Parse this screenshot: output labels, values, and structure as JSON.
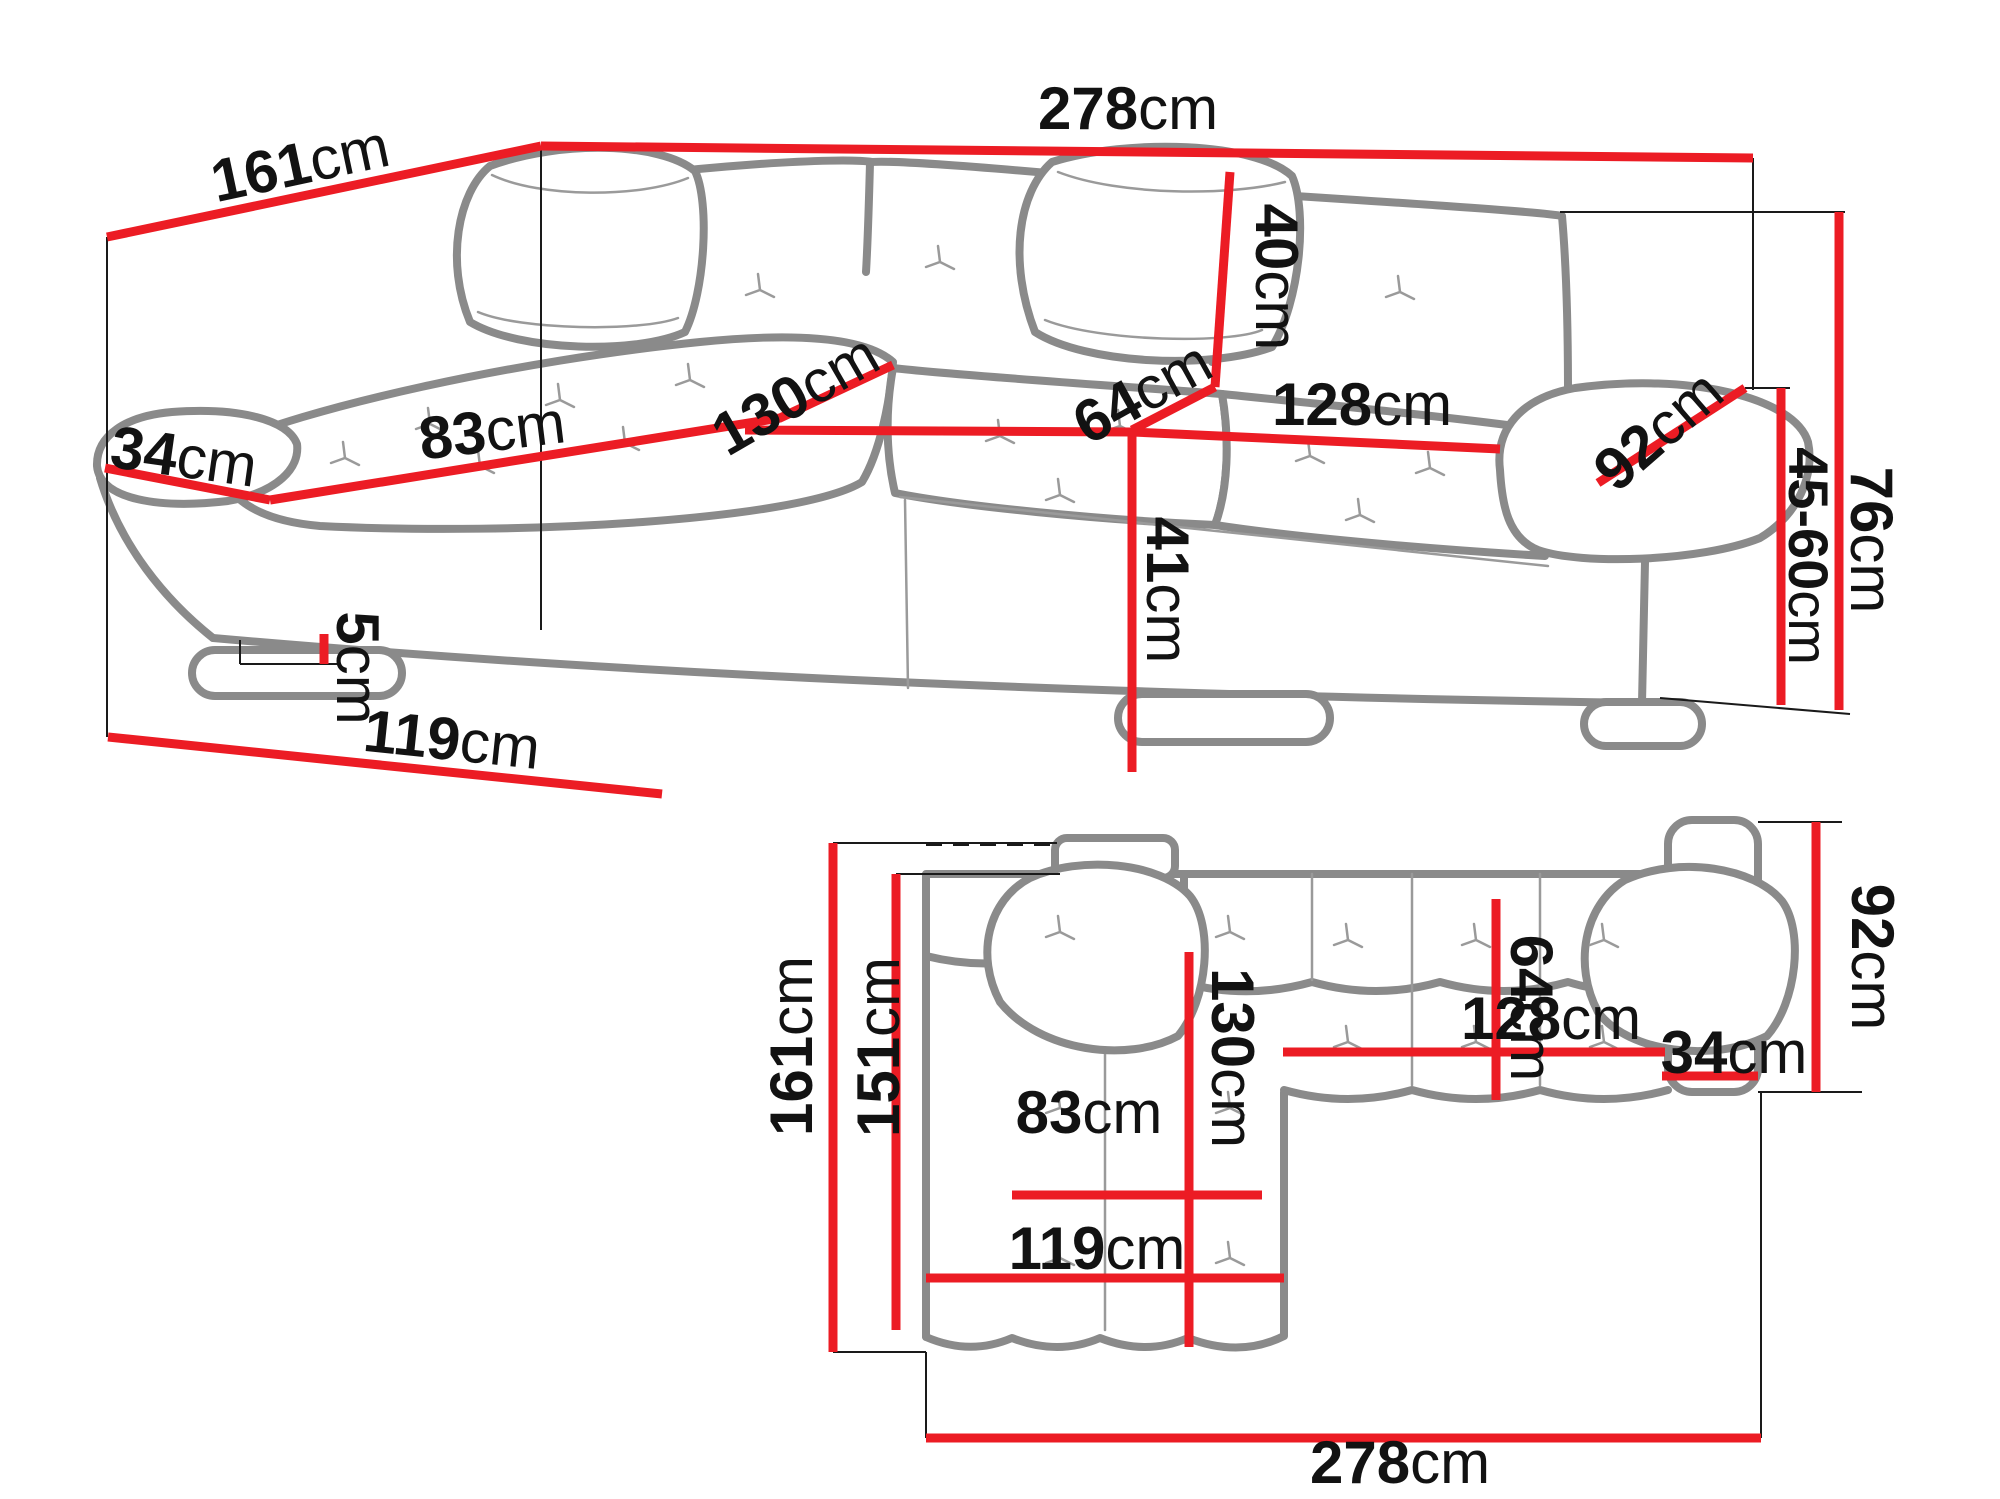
{
  "diagram": {
    "type": "furniture-dimension-drawing",
    "subject": "corner-sofa",
    "views": {
      "perspective": {
        "name": "perspective-view",
        "dimensions": [
          {
            "id": "p161",
            "value": "161",
            "unit": "cm"
          },
          {
            "id": "p278",
            "value": "278",
            "unit": "cm"
          },
          {
            "id": "p40",
            "value": "40",
            "unit": "cm"
          },
          {
            "id": "p64",
            "value": "64",
            "unit": "cm"
          },
          {
            "id": "p128",
            "value": "128",
            "unit": "cm"
          },
          {
            "id": "p92",
            "value": "92",
            "unit": "cm"
          },
          {
            "id": "p76",
            "value": "76",
            "unit": "cm"
          },
          {
            "id": "p4560",
            "value": "45-60",
            "unit": "cm"
          },
          {
            "id": "p41",
            "value": "41",
            "unit": "cm"
          },
          {
            "id": "p34",
            "value": "34",
            "unit": "cm"
          },
          {
            "id": "p83",
            "value": "83",
            "unit": "cm"
          },
          {
            "id": "p130",
            "value": "130",
            "unit": "cm"
          },
          {
            "id": "p5",
            "value": "5",
            "unit": "cm"
          },
          {
            "id": "p119",
            "value": "119",
            "unit": "cm"
          }
        ]
      },
      "plan": {
        "name": "top-plan-view",
        "dimensions": [
          {
            "id": "q161",
            "value": "161",
            "unit": "cm"
          },
          {
            "id": "q151",
            "value": "151",
            "unit": "cm"
          },
          {
            "id": "q130",
            "value": "130",
            "unit": "cm"
          },
          {
            "id": "q64",
            "value": "64",
            "unit": "cm"
          },
          {
            "id": "q128",
            "value": "128",
            "unit": "cm"
          },
          {
            "id": "q34",
            "value": "34",
            "unit": "cm"
          },
          {
            "id": "q92",
            "value": "92",
            "unit": "cm"
          },
          {
            "id": "q83",
            "value": "83",
            "unit": "cm"
          },
          {
            "id": "q119",
            "value": "119",
            "unit": "cm"
          },
          {
            "id": "q278",
            "value": "278",
            "unit": "cm"
          }
        ]
      }
    },
    "colors": {
      "dimension_line": "#ec1c24",
      "sofa_outline": "#8a8a8a",
      "thin_detail": "#9a9a9a",
      "extension_line": "#1a1a1a",
      "text": "#121212",
      "background": "#ffffff"
    }
  },
  "labels": {
    "p161": {
      "value": "161",
      "unit": "cm"
    },
    "p278": {
      "value": "278",
      "unit": "cm"
    },
    "p40": {
      "value": "40",
      "unit": "cm"
    },
    "p64": {
      "value": "64",
      "unit": "cm"
    },
    "p128": {
      "value": "128",
      "unit": "cm"
    },
    "p92": {
      "value": "92",
      "unit": "cm"
    },
    "p76": {
      "value": "76",
      "unit": "cm"
    },
    "p4560": {
      "value": "45-60",
      "unit": "cm"
    },
    "p41": {
      "value": "41",
      "unit": "cm"
    },
    "p34": {
      "value": "34",
      "unit": "cm"
    },
    "p83": {
      "value": "83",
      "unit": "cm"
    },
    "p130": {
      "value": "130",
      "unit": "cm"
    },
    "p5": {
      "value": "5",
      "unit": "cm"
    },
    "p119": {
      "value": "119",
      "unit": "cm"
    },
    "q161": {
      "value": "161",
      "unit": "cm"
    },
    "q151": {
      "value": "151",
      "unit": "cm"
    },
    "q130": {
      "value": "130",
      "unit": "cm"
    },
    "q64": {
      "value": "64",
      "unit": "cm"
    },
    "q128": {
      "value": "128",
      "unit": "cm"
    },
    "q34": {
      "value": "34",
      "unit": "cm"
    },
    "q92": {
      "value": "92",
      "unit": "cm"
    },
    "q83": {
      "value": "83",
      "unit": "cm"
    },
    "q119": {
      "value": "119",
      "unit": "cm"
    },
    "q278": {
      "value": "278",
      "unit": "cm"
    }
  }
}
